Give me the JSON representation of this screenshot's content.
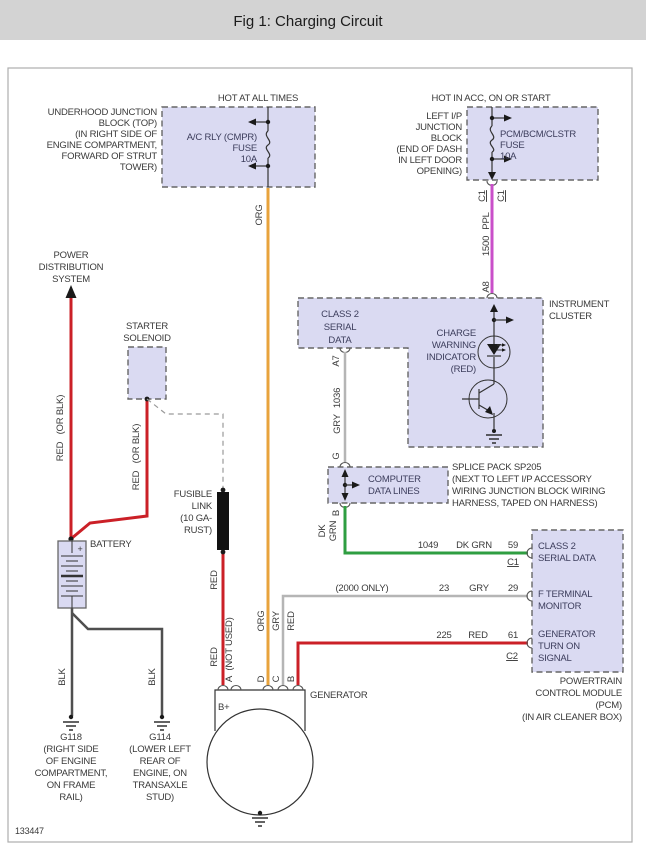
{
  "title": "Fig 1: Charging Circuit",
  "figure_id": "133447",
  "colors": {
    "header_bg": "#d3d3d3",
    "box_fill": "#dadaf2",
    "wire_red": "#cb2027",
    "wire_orange": "#e8a33c",
    "wire_purple": "#c94fc9",
    "wire_green": "#2f9e41",
    "wire_gray": "#b5b5b5",
    "wire_black": "#4f4f4f",
    "fuselink_fill": "#111111"
  },
  "top_left": {
    "hot_label": "HOT AT ALL TIMES",
    "block_label": [
      "UNDERHOOD JUNCTION",
      "BLOCK (TOP)",
      "(IN RIGHT SIDE OF",
      "ENGINE COMPARTMENT,",
      "FORWARD OF STRUT",
      "TOWER)"
    ],
    "fuse_label": [
      "A/C RLY (CMPR)",
      "FUSE",
      "10A"
    ],
    "wire_color": "ORG"
  },
  "top_right": {
    "hot_label": "HOT IN ACC, ON OR START",
    "block_label": [
      "LEFT I/P",
      "JUNCTION",
      "BLOCK",
      "(END OF DASH",
      "IN LEFT DOOR",
      "OPENING)"
    ],
    "fuse_label": [
      "PCM/BCM/CLSTR",
      "FUSE",
      "10A"
    ],
    "connector_left": "C1",
    "connector_right": "C1",
    "wire_circuit": "1500",
    "wire_color": "PPL",
    "connector_a8": "A8"
  },
  "instrument_cluster": {
    "label": [
      "INSTRUMENT",
      "CLUSTER"
    ],
    "class2_label": [
      "CLASS 2",
      "SERIAL",
      "DATA"
    ],
    "charge_label": [
      "CHARGE",
      "WARNING",
      "INDICATOR",
      "(RED)"
    ],
    "connector_a7": "A7",
    "wire_circuit": "1036",
    "wire_color": "GRY"
  },
  "computer_data_lines": {
    "label": [
      "COMPUTER",
      "DATA LINES"
    ],
    "connector_top": "G",
    "connector_bottom": "B",
    "splice_label": [
      "SPLICE PACK SP205",
      "(NEXT TO LEFT I/P ACCESSORY",
      "WIRING JUNCTION BLOCK WIRING",
      "HARNESS, TAPED ON HARNESS)"
    ],
    "wire_color_1": "DK",
    "wire_color_2": "GRN"
  },
  "left_side": {
    "power_label": [
      "POWER",
      "DISTRIBUTION",
      "SYSTEM"
    ],
    "starter_label": [
      "STARTER",
      "SOLENOID"
    ],
    "wire_red_or_blk": "RED   (OR BLK)",
    "battery_label": "BATTERY",
    "battery_plus": "+",
    "fusible_label": [
      "FUSIBLE",
      "LINK",
      "(10 GA-",
      "RUST)"
    ],
    "wire_red": "RED",
    "wire_blk": "BLK",
    "g118_label": [
      "G118",
      "(RIGHT SIDE",
      "OF ENGINE",
      "COMPARTMENT,",
      "ON FRAME",
      "RAIL)"
    ],
    "g114_label": [
      "G114",
      "(LOWER LEFT",
      "REAR OF",
      "ENGINE, ON",
      "TRANSAXLE",
      "STUD)"
    ]
  },
  "generator": {
    "label": "GENERATOR",
    "b_plus": "B+",
    "terminals": [
      {
        "id": "A",
        "wire": "(NOT USED)"
      },
      {
        "id": "D",
        "wire": "ORG"
      },
      {
        "id": "C",
        "wire": "GRY"
      },
      {
        "id": "B",
        "wire": "RED"
      }
    ]
  },
  "pcm": {
    "rows": [
      {
        "circuit": "1049",
        "color": "DK GRN",
        "pin": "59",
        "connector": "C1",
        "label": [
          "CLASS 2",
          "SERIAL DATA"
        ]
      },
      {
        "note": "(2000 ONLY)",
        "circuit": "23",
        "color": "GRY",
        "pin": "29",
        "label": [
          "F TERMINAL",
          "MONITOR"
        ]
      },
      {
        "circuit": "225",
        "color": "RED",
        "pin": "61",
        "connector": "C2",
        "label": [
          "GENERATOR",
          "TURN ON",
          "SIGNAL"
        ]
      }
    ],
    "block_label": [
      "POWERTRAIN",
      "CONTROL MODULE",
      "(PCM)",
      "(IN AIR CLEANER BOX)"
    ]
  }
}
